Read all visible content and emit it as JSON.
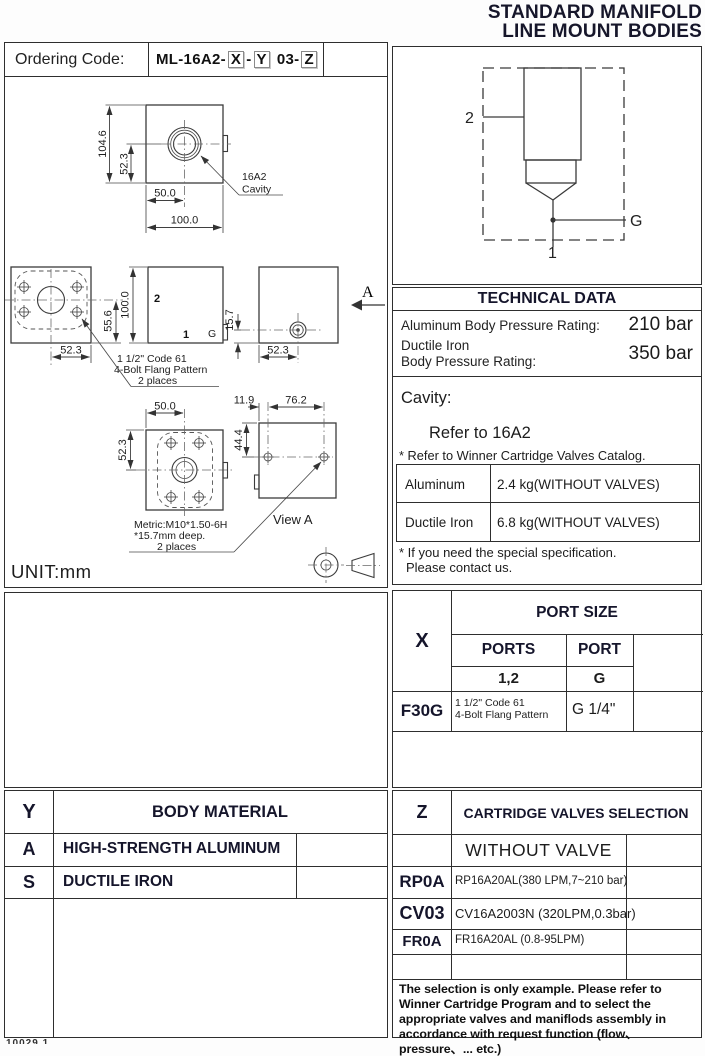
{
  "title": {
    "line1": "STANDARD MANIFOLD",
    "line2": "LINE MOUNT BODIES"
  },
  "ordering": {
    "label": "Ordering Code:",
    "prefix": "ML-16A2-",
    "x": "X",
    "dash1": "-",
    "y": "Y",
    "mid": "03-",
    "z": "Z"
  },
  "dims": {
    "d104_6": "104.6",
    "d52_3": "52.3",
    "d50_0": "50.0",
    "d100_0": "100.0",
    "d55_6": "55.6",
    "d15_7": "15.7",
    "d11_9": "11.9",
    "d76_2": "76.2",
    "d44_4": "44.4"
  },
  "drawing": {
    "cavity_callout_line1": "16A2",
    "cavity_callout_line2": "Cavity",
    "flange_note_line1": "1 1/2\" Code 61",
    "flange_note_line2": "4-Bolt Flang Pattern",
    "flange_note_line3": "2 places",
    "metric_note_line1": "Metric:M10*1.50-6H",
    "metric_note_line2": "*15.7mm deep.",
    "metric_note_line3": "2 places",
    "view_a_label": "View A",
    "view_arrow_label": "A",
    "port_1": "1",
    "port_2": "2",
    "port_g": "G",
    "unit": "UNIT:mm"
  },
  "schematic": {
    "port_1": "1",
    "port_2": "2",
    "port_g": "G"
  },
  "technical": {
    "header": "TECHNICAL DATA",
    "aluminum_label": "Aluminum Body Pressure Rating:",
    "aluminum_value": "210 bar",
    "ductile_label_line1": "Ductile Iron",
    "ductile_label_line2": "Body Pressure Rating:",
    "ductile_value": "350 bar",
    "cavity_label": "Cavity:",
    "cavity_value": "Refer to 16A2",
    "cavity_note": "* Refer to Winner Cartridge Valves Catalog.",
    "weights": [
      {
        "material": "Aluminum",
        "value": "2.4  kg(WITHOUT VALVES)"
      },
      {
        "material": "Ductile Iron",
        "value": "6.8  kg(WITHOUT VALVES)"
      }
    ],
    "note_line1": "* If you need the special specification.",
    "note_line2": "Please contact us."
  },
  "port_size": {
    "key": "X",
    "header": "PORT SIZE",
    "col1_header": "PORTS",
    "col2_header": "PORT",
    "col1_sub": "1,2",
    "col2_sub": "G",
    "rows": [
      {
        "key": "F30G",
        "ports_line1": "1 1/2\" Code 61",
        "ports_line2": "4-Bolt Flang Pattern",
        "port": "G 1/4\""
      }
    ]
  },
  "body_material": {
    "key": "Y",
    "header": "BODY MATERIAL",
    "rows": [
      {
        "key": "A",
        "label": "HIGH-STRENGTH ALUMINUM"
      },
      {
        "key": "S",
        "label": "DUCTILE IRON"
      }
    ]
  },
  "cartridge": {
    "key": "Z",
    "header": "CARTRIDGE VALVES SELECTION",
    "without_valve": "WITHOUT VALVE",
    "rows": [
      {
        "key": "RP0A",
        "label": "RP16A20AL(380 LPM,7~210 bar)"
      },
      {
        "key": "CV03",
        "label": "CV16A2003N (320LPM,0.3bar)"
      },
      {
        "key": "FR0A",
        "label": "FR16A20AL (0.8-95LPM)"
      }
    ],
    "note": "The selection is only example. Please refer to Winner Cartridge Program and to select the appropriate valves and maniflods assembly in accordance with request function (flow、pressure、... etc.)"
  },
  "footer": {
    "partial": "10029.1"
  }
}
